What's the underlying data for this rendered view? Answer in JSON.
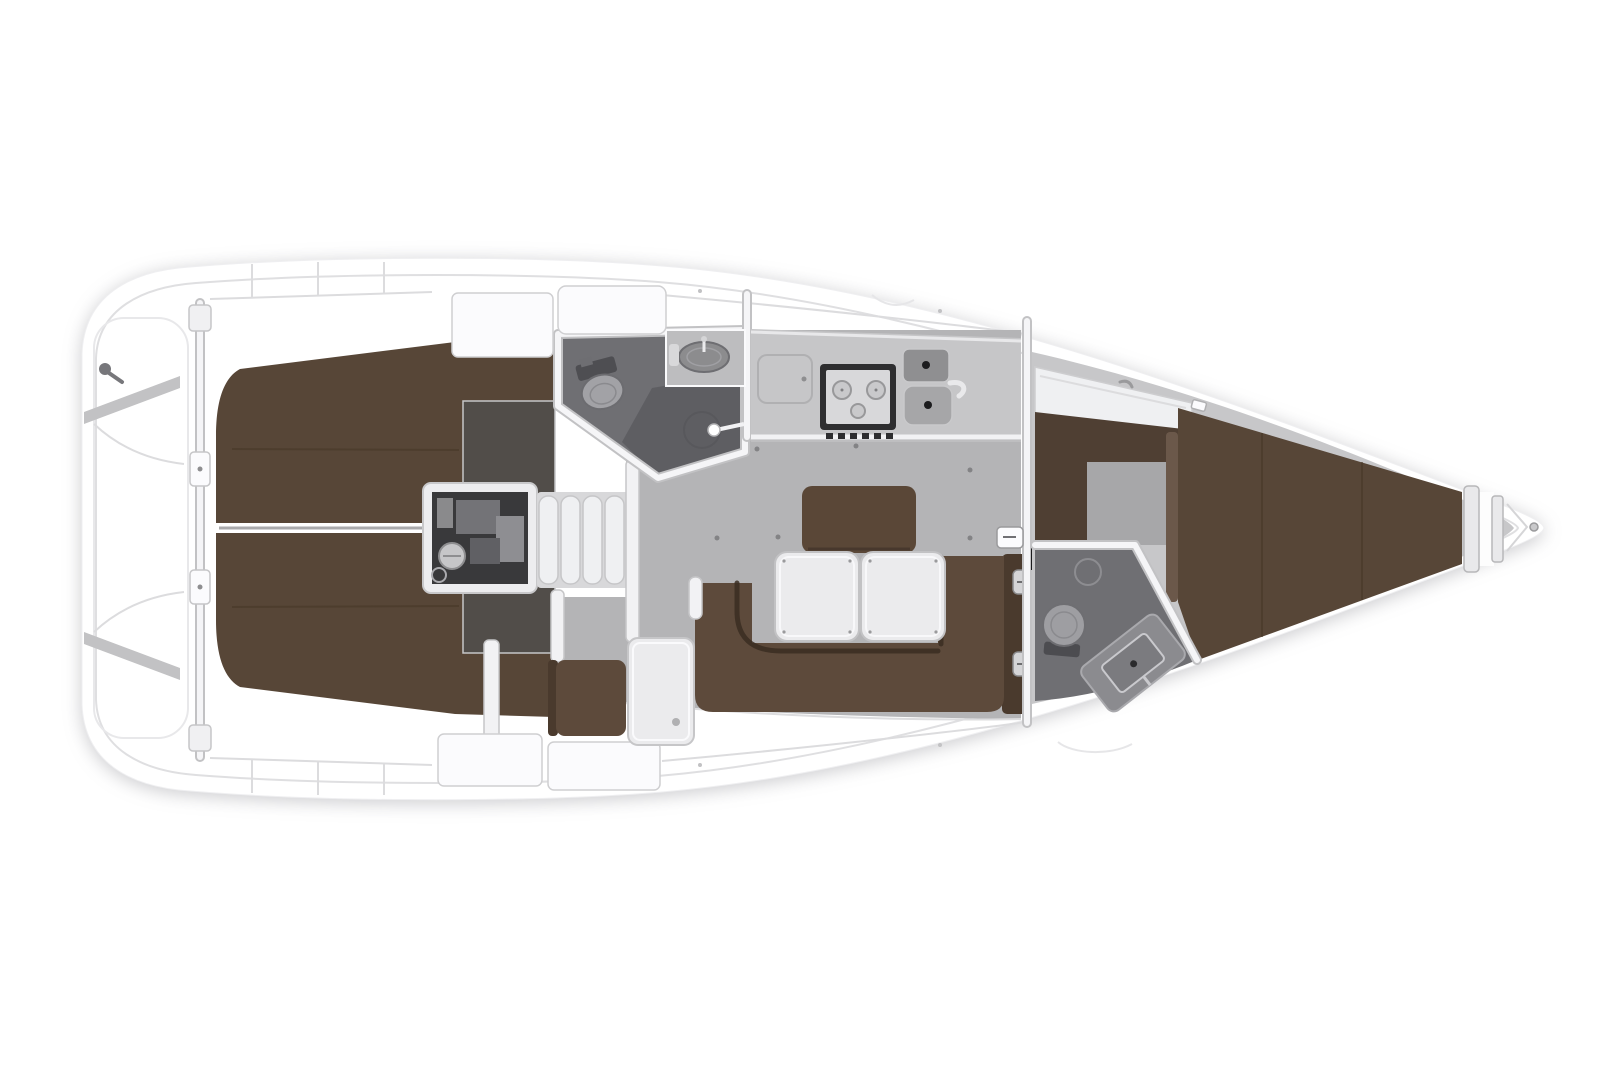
{
  "image": {
    "kind": "yacht-interior-floorplan",
    "orientation": "bow-right",
    "background": "#ffffff"
  },
  "areas": {
    "stern_platform": "transom-swim-platform",
    "aft_cabin_port": "aft-double-cabin-top",
    "aft_cabin_starboard": "aft-double-cabin-bottom",
    "engine": "engine-compartment",
    "companionway": "companionway-steps",
    "aft_head": "aft-bathroom-with-shower",
    "galley": "galley-with-stove-and-sink",
    "saloon": "saloon-u-settee-and-tables",
    "nav_station": "chart-table-and-seat",
    "forward_cabin": "forward-v-berth-cabin",
    "forward_head": "forward-bathroom",
    "bow": "anchor-locker"
  },
  "colors": {
    "hull": "#ffffff",
    "liner": "#c7c7c9",
    "saloon_floor": "#b4b4b6",
    "fwd_floor": "#a7a7a9",
    "cabin_floor_dark": "#514d49",
    "head_floor": "#6f6f73",
    "head_floor_dark": "#5c5c60",
    "berth": "#574637",
    "berth_step": "#6b584a",
    "cabinet_brown": "#4f3f33",
    "settee": "#5d4a3b",
    "settee_dark": "#4a3a2d",
    "island": "#5a4737",
    "table": "#ebebed",
    "counter": "#c6c6c8",
    "stove_frame": "#2e2e30",
    "stove_panel": "#d8d8da",
    "sink_dark": "#8f8f91",
    "sink_light": "#a6a6a8",
    "engine_bay": "#39393b",
    "wall_fill": "#f2f2f4",
    "white_box": "#fbfbfd",
    "anchor_gray": "#b5b5b7",
    "fitting_gray": "#77777b"
  }
}
